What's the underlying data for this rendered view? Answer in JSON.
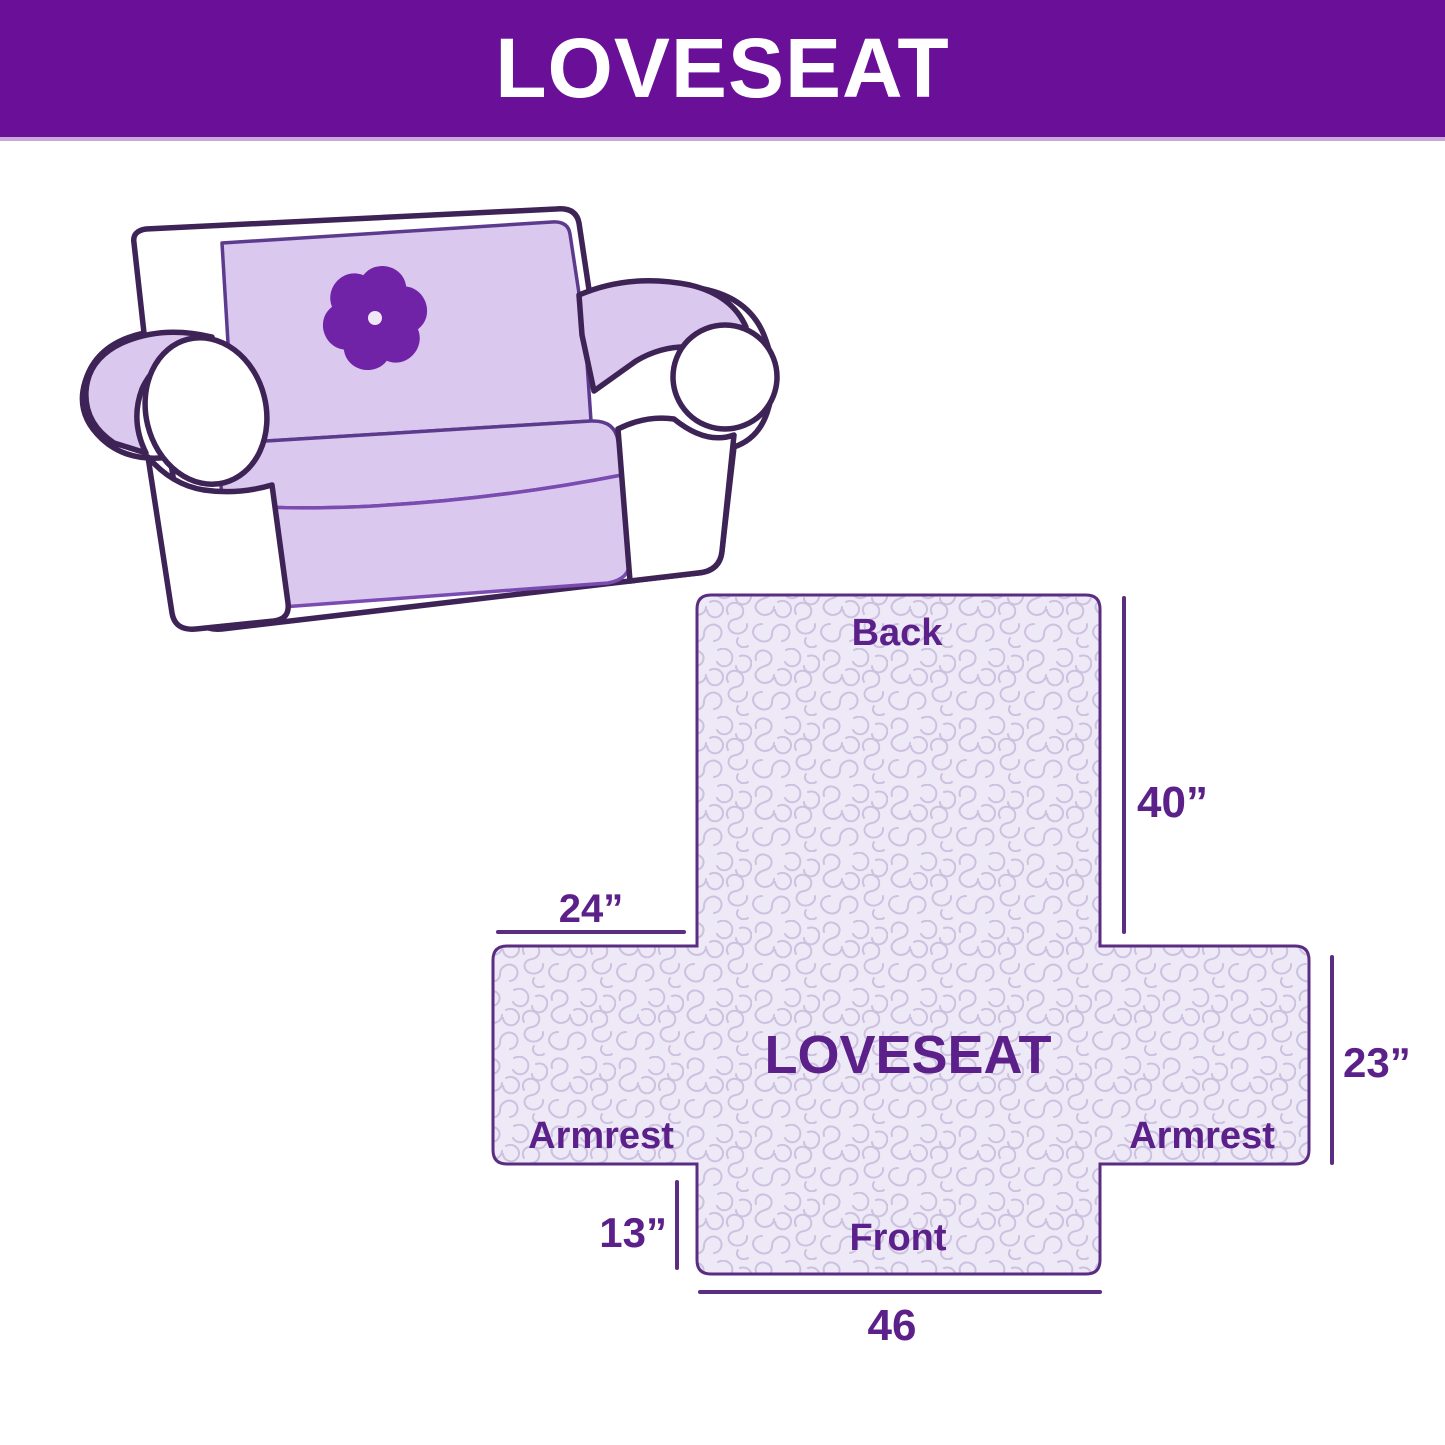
{
  "header": {
    "title": "LOVESEAT"
  },
  "illustration": {
    "alt": "loveseat covered with quilted lavender furniture protector",
    "logo": "pinwheel-flower"
  },
  "diagram": {
    "product_label": "LOVESEAT",
    "back_label": "Back",
    "front_label": "Front",
    "armrest_left_label": "Armrest",
    "armrest_right_label": "Armrest",
    "dim_back_height": "40”",
    "dim_armrest_top": "24”",
    "dim_armrest_side": "23”",
    "dim_front_skirt": "13”",
    "dim_front_width": "46"
  },
  "colors": {
    "banner": "#6A1098",
    "banner_text": "#FFFFFF",
    "outline": "#3E2356",
    "cover_fill": "#DBC8EE",
    "pinwheel": "#7123A7",
    "quilt_fill": "#EEE9F6",
    "quilt_line": "#CDC1E0",
    "diagram_line": "#5A2D82",
    "diagram_text": "#5B2089"
  }
}
